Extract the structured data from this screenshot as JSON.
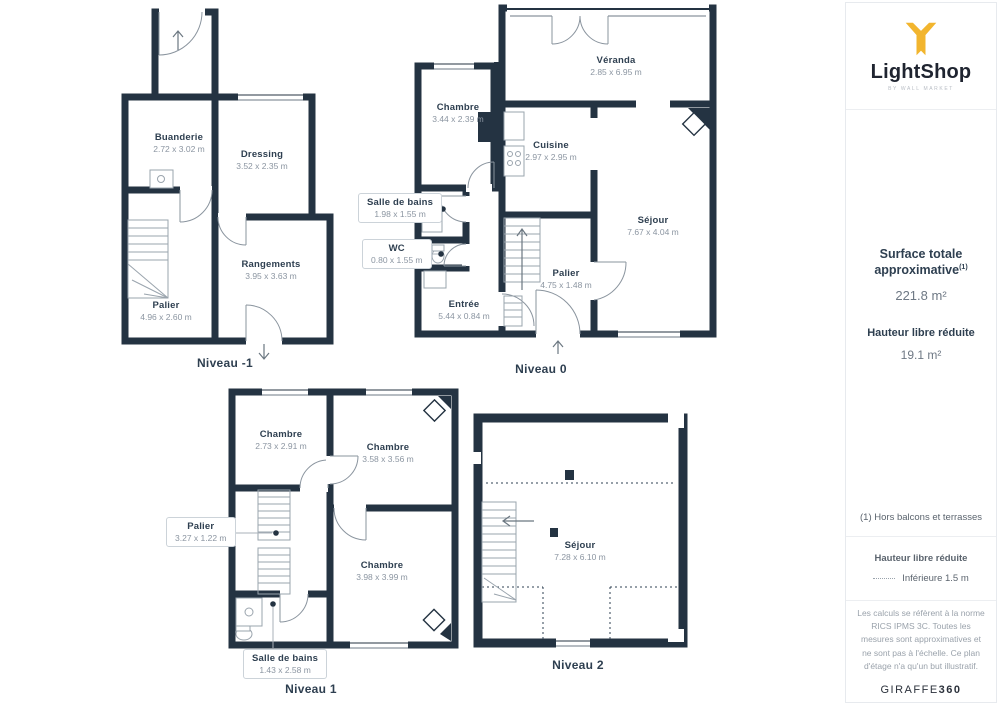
{
  "sidebar": {
    "logo": {
      "brand": "LightShop",
      "tagline": "BY WALL MARKET"
    },
    "surface": {
      "title": "Surface totale approximative",
      "sup": "(1)",
      "value": "221.8 m²"
    },
    "height": {
      "title": "Hauteur libre réduite",
      "value": "19.1 m²"
    },
    "footnote": "(1) Hors balcons et terrasses",
    "legend": {
      "title": "Hauteur libre réduite",
      "item": "Inférieure 1.5 m"
    },
    "disclaimer": "Les calculs se réfèrent à la norme RICS IPMS 3C. Toutes les mesures sont approximatives et ne sont pas à l'échelle. Ce plan d'étage n'a qu'un but illustratif.",
    "brand_footer": {
      "name": "GIRAFFE",
      "suffix": "360"
    }
  },
  "colors": {
    "wall": "#243342",
    "accent": "#F2B52E",
    "label": "#2e3f50",
    "dim": "#8b95a1"
  },
  "levels": [
    {
      "id": "niveau-m1",
      "caption": "Niveau -1",
      "rooms": [
        {
          "name": "Buanderie",
          "dims": "2.72 x 3.02 m"
        },
        {
          "name": "Dressing",
          "dims": "3.52 x 2.35 m"
        },
        {
          "name": "Rangements",
          "dims": "3.95 x 3.63 m"
        },
        {
          "name": "Palier",
          "dims": "4.96 x 2.60 m"
        }
      ]
    },
    {
      "id": "niveau-0",
      "caption": "Niveau 0",
      "rooms": [
        {
          "name": "Chambre",
          "dims": "3.44 x 2.39 m"
        },
        {
          "name": "Véranda",
          "dims": "2.85 x 6.95 m"
        },
        {
          "name": "Cuisine",
          "dims": "2.97 x 2.95 m"
        },
        {
          "name": "Séjour",
          "dims": "7.67 x 4.04 m"
        },
        {
          "name": "Palier",
          "dims": "4.75 x 1.48 m"
        },
        {
          "name": "Entrée",
          "dims": "5.44 x 0.84 m"
        },
        {
          "name": "Salle de bains",
          "dims": "1.98 x 1.55 m"
        },
        {
          "name": "WC",
          "dims": "0.80 x 1.55 m"
        }
      ]
    },
    {
      "id": "niveau-1",
      "caption": "Niveau 1",
      "rooms": [
        {
          "name": "Chambre",
          "dims": "2.73 x 2.91 m"
        },
        {
          "name": "Chambre",
          "dims": "3.58 x 3.56 m"
        },
        {
          "name": "Chambre",
          "dims": "3.98 x 3.99 m"
        },
        {
          "name": "Palier",
          "dims": "3.27 x 1.22 m"
        },
        {
          "name": "Salle de bains",
          "dims": "1.43 x 2.58 m"
        }
      ]
    },
    {
      "id": "niveau-2",
      "caption": "Niveau 2",
      "rooms": [
        {
          "name": "Séjour",
          "dims": "7.28 x 6.10 m"
        }
      ]
    }
  ]
}
